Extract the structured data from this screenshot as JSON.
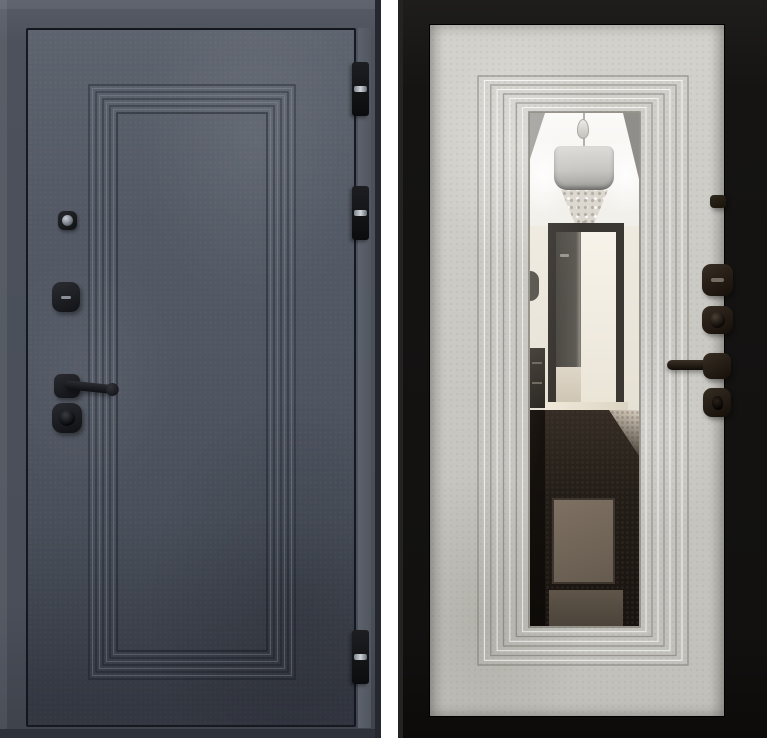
{
  "figure": {
    "alt": "Product photo of a steel entry door shown from both sides",
    "background_color": "#ffffff",
    "views": [
      {
        "id": "exterior",
        "label": "Exterior side: dark graphite concrete finish with stepped panel molding"
      },
      {
        "id": "interior",
        "label": "Interior side: light beige panel with full-length mirror reflecting a hallway"
      }
    ]
  },
  "exterior_door": {
    "finish": "dark graphite concrete texture",
    "finish_color": "#4f5560",
    "outline_color": "#10131a",
    "molding": "concentric stepped rectangle grooves",
    "hardware_color": "#17181c",
    "parts": {
      "peephole": "peephole",
      "thumbturn": "deadbolt thumb-turn",
      "handle": "lever handle (pointing right)",
      "cylinder": "key cylinder rose",
      "hinges": "barrel hinges on right edge"
    },
    "hinge_count": 3,
    "hinge_color": "#141518",
    "hinge_pin_color": "#c9ced5"
  },
  "interior_door": {
    "finish": "light beige concrete texture",
    "panel_color": "#c9c8c2",
    "frame_color": "#141312",
    "molding": "concentric stepped rectangle grooves around mirror",
    "hardware_color": "#241d17",
    "mirror": {
      "description": "full-length mirror reflecting a hallway interior",
      "reflection": [
        "white ceiling with cove lighting",
        "drum-shade chandelier with crystal cascade",
        "open interior doorway with dark casing",
        "dark glossy marble floor with lighter inlay"
      ]
    },
    "parts": {
      "peephole_cover": "peephole cover",
      "thumbturn": "thumb-turn",
      "night_latch": "night-latch knob",
      "handle": "lever handle (pointing left)",
      "escutcheon": "key escutcheon"
    }
  }
}
